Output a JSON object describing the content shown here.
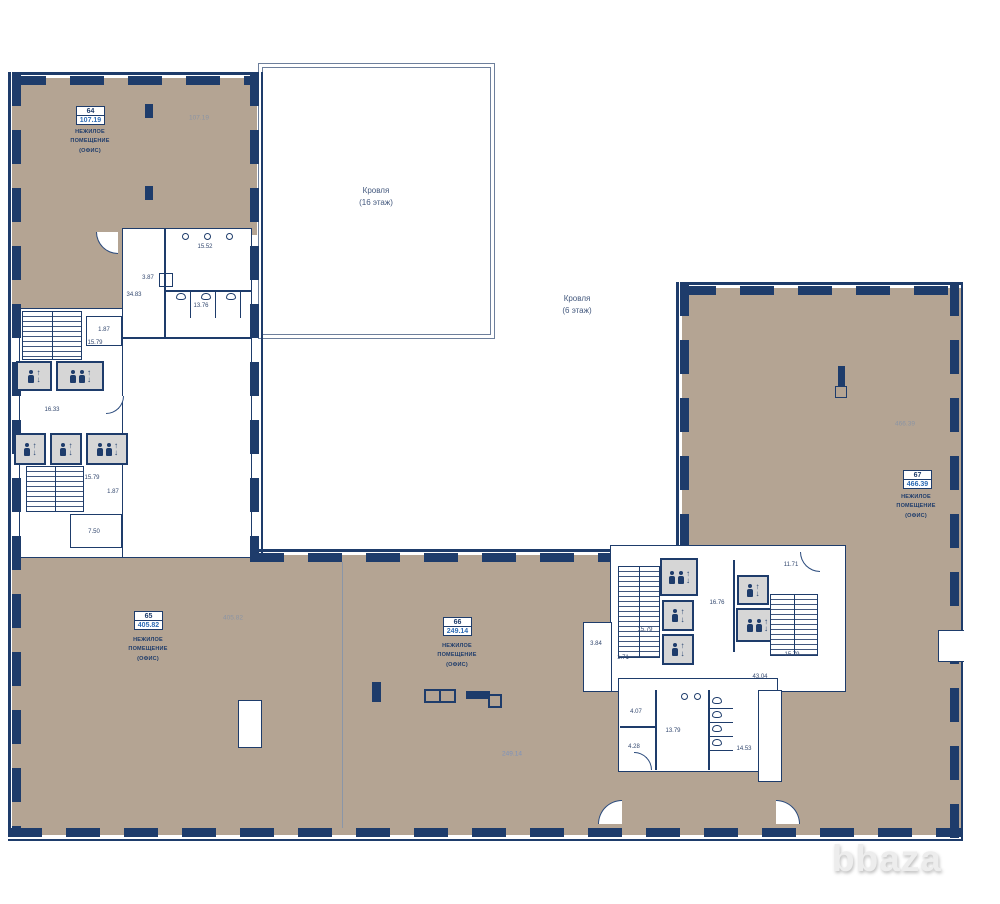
{
  "watermark": "bbaza",
  "icons": {
    "up": "↑",
    "down": "↓"
  },
  "colors": {
    "beige": "#b4a493",
    "navy": "#1e3c6b",
    "badge_blue": "#2e6cb5",
    "elevator_fill": "#d6d6d6"
  },
  "rooms": [
    {
      "number": "64",
      "area": "107.19",
      "floating_area": "107.19",
      "name": [
        "НЕЖИЛОЕ",
        "ПОМЕЩЕНИЕ",
        "(ОФИС)"
      ]
    },
    {
      "number": "65",
      "area": "405.82",
      "floating_area": "405.82",
      "name": [
        "НЕЖИЛОЕ",
        "ПОМЕЩЕНИЕ",
        "(ОФИС)"
      ]
    },
    {
      "number": "66",
      "area": "249.14",
      "floating_area": "249.14",
      "name": [
        "НЕЖИЛОЕ",
        "ПОМЕЩЕНИЕ",
        "(ОФИС)"
      ]
    },
    {
      "number": "67",
      "area": "466.39",
      "floating_area": "466.39",
      "name": [
        "НЕЖИЛОЕ",
        "ПОМЕЩЕНИЕ",
        "(ОФИС)"
      ]
    }
  ],
  "roofs": [
    {
      "title": "Кровля",
      "floor": "(16 этаж)"
    },
    {
      "title": "Кровля",
      "floor": "(6 этаж)"
    }
  ],
  "dims_left": {
    "wc_top": "15.52",
    "wc_mid": "13.76",
    "shaft": "3.87",
    "entry": "34.83",
    "r1": "1.87",
    "r2": "15.79",
    "hall": "16.33",
    "r3": "15.79",
    "r4": "1.87",
    "r5": "7.50"
  },
  "dims_right": {
    "top": "11.71",
    "stair_l": "15.79",
    "lobby": "16.76",
    "stair_r": "15.79",
    "v1": "3.84",
    "v2": "1.71",
    "hall": "43.04",
    "wc1": "4.07",
    "wc2": "4.28",
    "wc3": "13.79",
    "wc4": "14.53"
  }
}
